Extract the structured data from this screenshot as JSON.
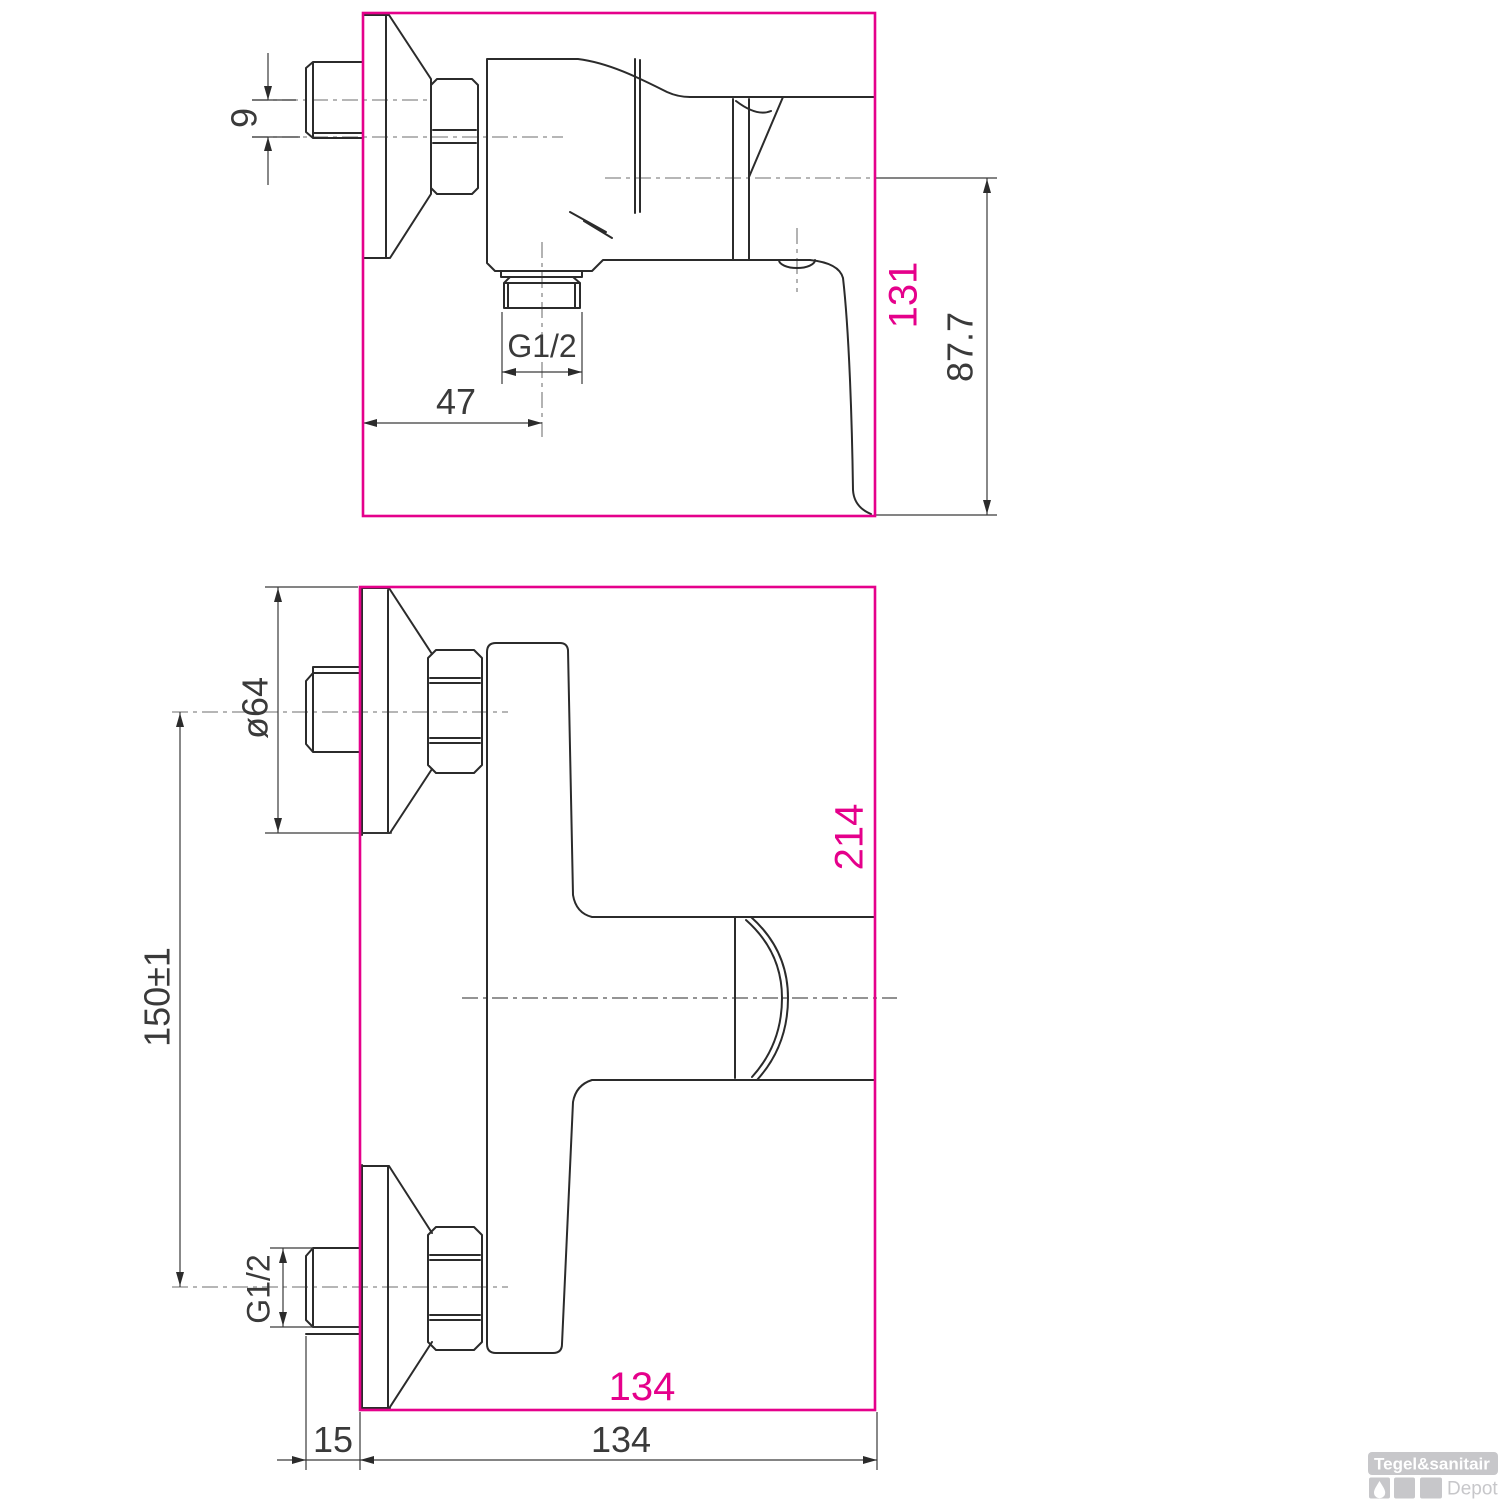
{
  "drawing": {
    "description": "Wall-mounted shower mixer tap - dimensional technical drawing with two views",
    "colors": {
      "highlight": "#e5008b",
      "line": "#2b2b2b",
      "centerline": "#8a8a8a",
      "dim_text": "#3a3a3a",
      "logo_grey": "#c7c7ca"
    },
    "top_view": {
      "label": "side view",
      "dims": {
        "inlet_offset": "9",
        "outlet_thread": "G1/2",
        "outlet_depth": "47",
        "overall_height": "131",
        "handle_drop": "87.7"
      }
    },
    "bottom_view": {
      "label": "plan view",
      "dims": {
        "flange_diameter": "ø64",
        "connection_pitch": "150±1",
        "inlet_thread": "G1/2",
        "overall_depth": "214",
        "overall_width_highlight": "134",
        "wall_clearance": "15",
        "overall_width": "134"
      }
    },
    "logo": {
      "brand": "Tegel&sanitair",
      "suffix": "Depot"
    }
  }
}
